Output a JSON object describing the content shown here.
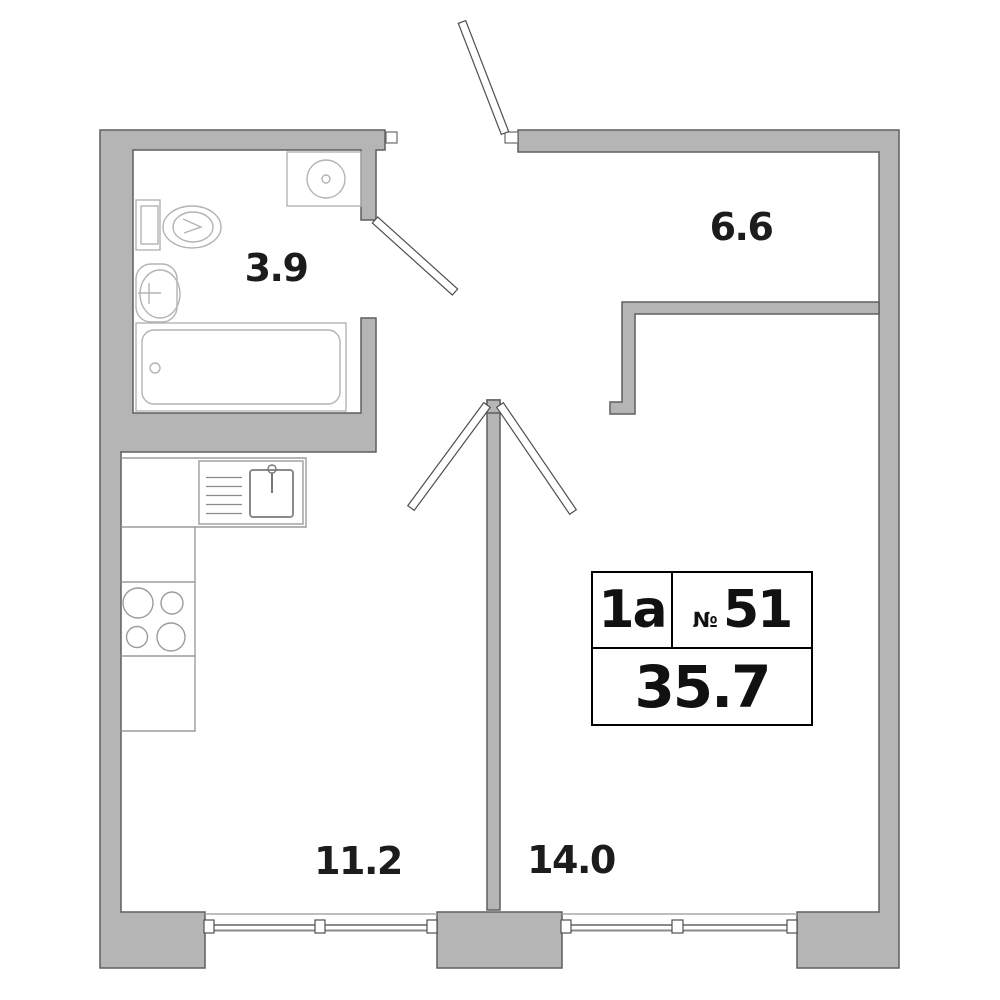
{
  "plan_title": "apartment-floor-plan",
  "rooms": [
    {
      "id": "bathroom",
      "area": "3.9"
    },
    {
      "id": "hallway",
      "area": "6.6"
    },
    {
      "id": "kitchen",
      "area": "11.2"
    },
    {
      "id": "living-room",
      "area": "14.0"
    }
  ],
  "card": {
    "layout_type": "1a",
    "number_symbol": "№",
    "number": "51",
    "total_area": "35.7"
  },
  "fixtures": [
    "bathtub",
    "toilet",
    "wash-basin",
    "washing-machine",
    "kitchen-sink",
    "stove",
    "kitchen-counter"
  ],
  "colors": {
    "background": "#ffffff",
    "wall_fill": "#b5b5b5",
    "wall_outline": "#5f5f5f",
    "fixture_line": "#b3b3b3",
    "counter_line": "#9c9c9c",
    "window_line": "#8a8a8a",
    "door_line": "#4f4f4f",
    "label_text": "#1c1c1c",
    "card_border": "#000000"
  }
}
